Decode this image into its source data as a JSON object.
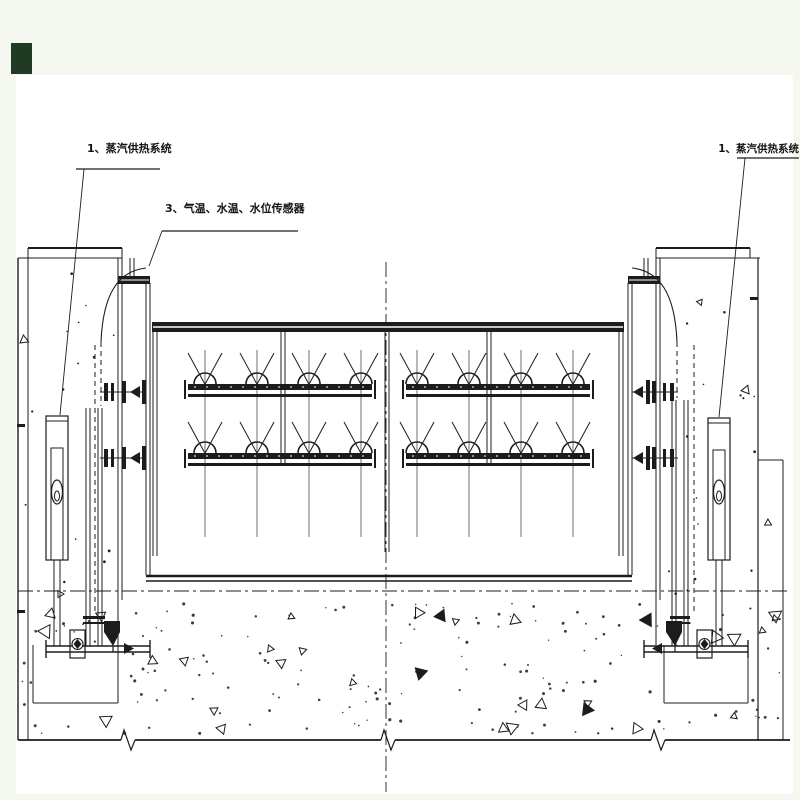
{
  "drawing": {
    "type": "engineering-section-drawing",
    "labels": {
      "steam_left": "1、蒸汽供热系统",
      "sensors": "3、气温、水温、水位传感器",
      "steam_right": "1、蒸汽供热系统"
    },
    "colors": {
      "margin": "#f5f8ee",
      "sheet": "#ffffff",
      "line": "#1c1c1c",
      "corner_square": "#213a24"
    }
  }
}
